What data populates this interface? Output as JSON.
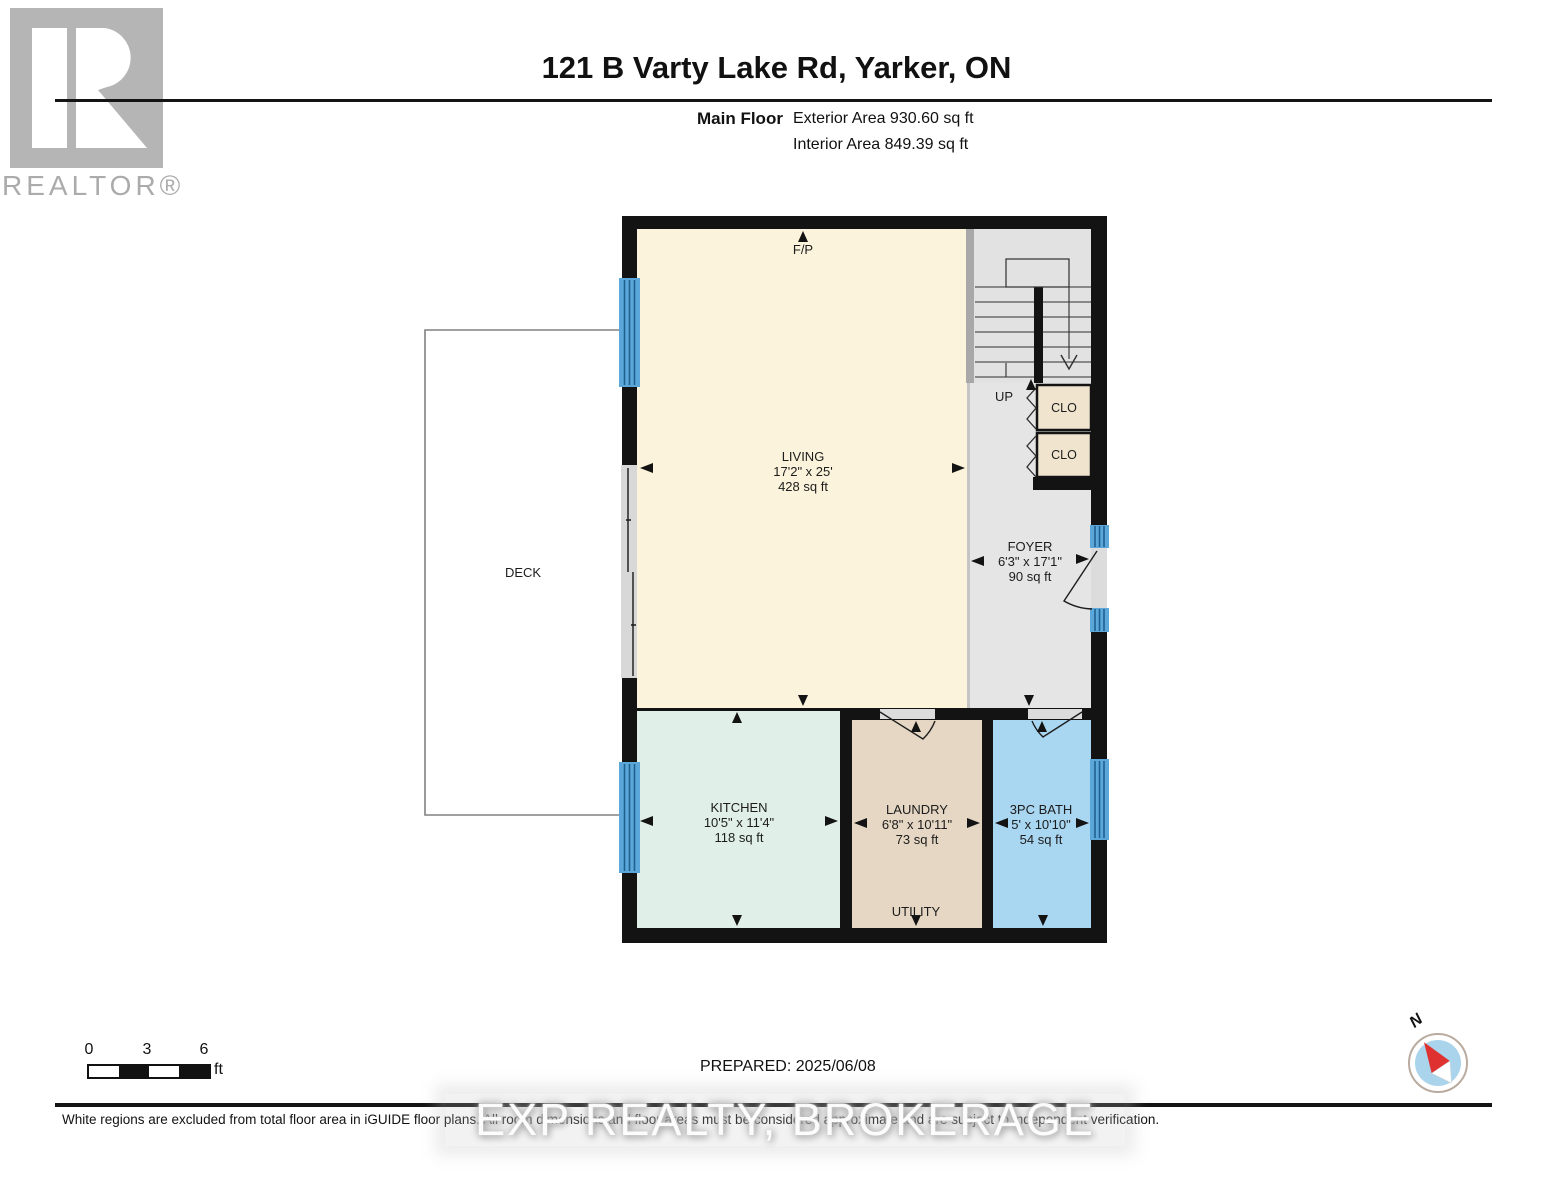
{
  "logo": {
    "brand": "REALTOR®"
  },
  "header": {
    "title": "121 B Varty Lake Rd, Yarker, ON",
    "floor_label": "Main Floor",
    "exterior_area": "Exterior Area 930.60 sq ft",
    "interior_area": "Interior Area 849.39 sq ft"
  },
  "plan": {
    "rooms": {
      "living": {
        "name": "LIVING",
        "dims": "17'2\" x 25'",
        "area": "428 sq ft"
      },
      "kitchen": {
        "name": "KITCHEN",
        "dims": "10'5\" x 11'4\"",
        "area": "118 sq ft"
      },
      "laundry": {
        "name": "LAUNDRY",
        "dims": "6'8\" x 10'11\"",
        "area": "73 sq ft"
      },
      "bath": {
        "name": "3PC BATH",
        "dims": "5' x 10'10\"",
        "area": "54 sq ft"
      },
      "foyer": {
        "name": "FOYER",
        "dims": "6'3\" x 17'1\"",
        "area": "90 sq ft"
      },
      "deck": {
        "name": "DECK"
      },
      "closet1": {
        "name": "CLO"
      },
      "closet2": {
        "name": "CLO"
      },
      "utility": {
        "name": "UTILITY"
      },
      "stairs_up_label": "UP",
      "fireplace_label": "F/P"
    },
    "colors": {
      "wall": "#131313",
      "living": "#FBF3DB",
      "kitchen": "#E0EFE8",
      "laundry": "#E5D7C3",
      "bath": "#A9D6F1",
      "foyer": "#E5E5E5",
      "stairs": "#E2E2E2",
      "closet": "#F0E4CF",
      "window_blue": "#5BA7DA",
      "opening_gray": "#DCDCDC",
      "deck_outline": "#808080"
    }
  },
  "footer": {
    "scale": {
      "tick0": "0",
      "tick3": "3",
      "tick6": "6",
      "unit": "ft"
    },
    "prepared": "PREPARED: 2025/06/08",
    "compass_north": "N",
    "disclaimer": "White regions are excluded from total floor area in iGUIDE floor plans. All room dimensions and floor areas must be considered approximate and are subject to independent verification.",
    "watermark": "EXP REALTY, BROKERAGE"
  }
}
